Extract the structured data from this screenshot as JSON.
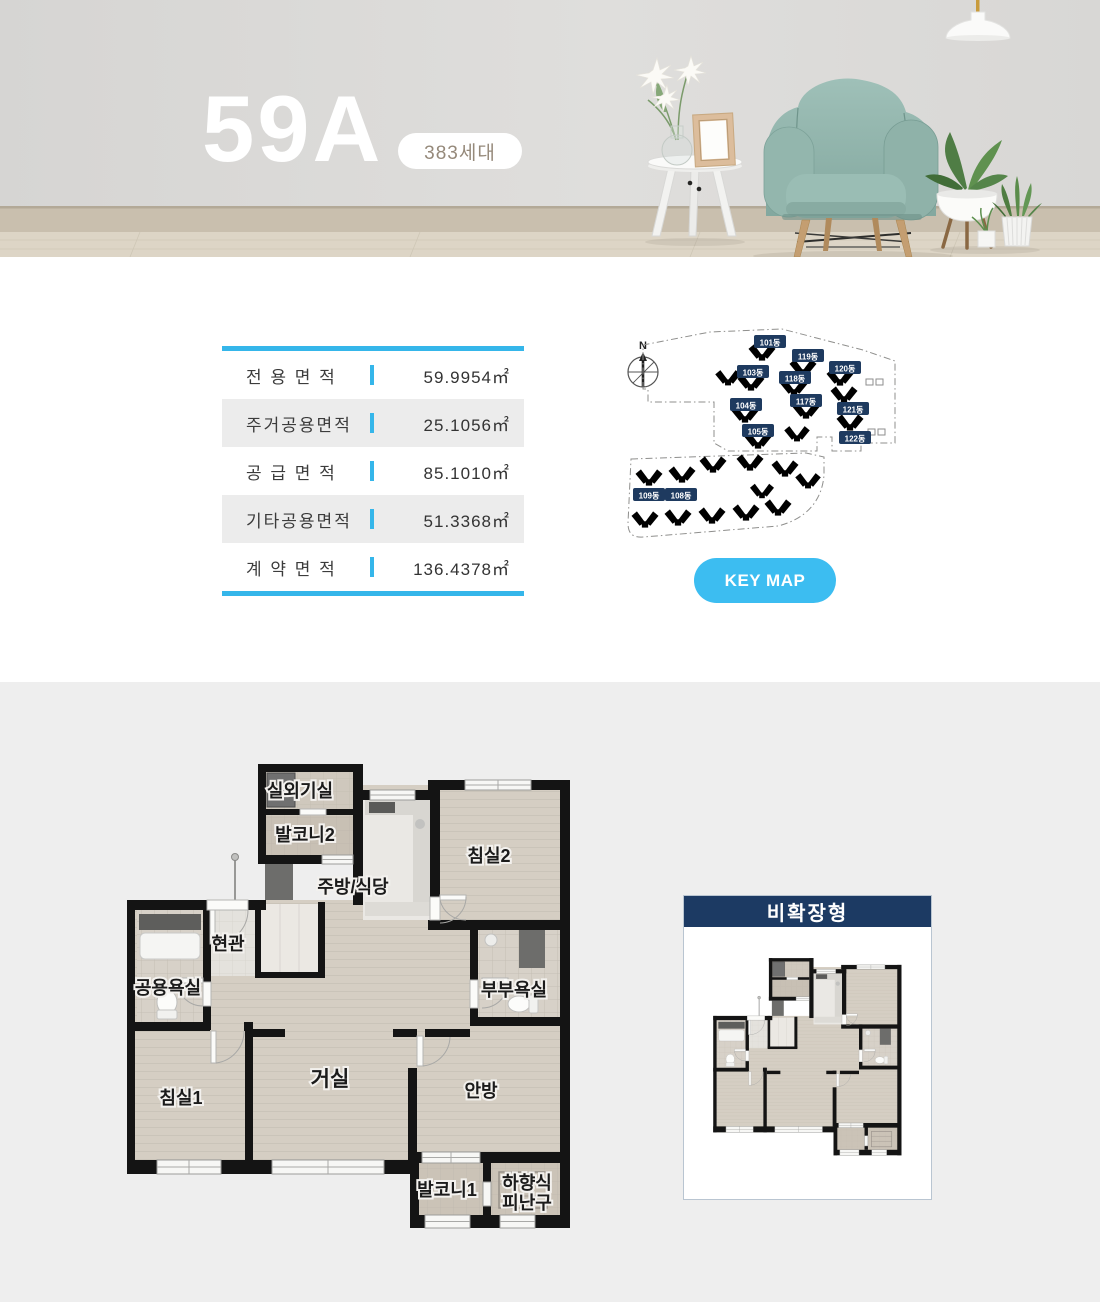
{
  "hero": {
    "title": "59A",
    "badge": "383세대"
  },
  "area_table": {
    "rows": [
      {
        "label": "전 용 면 적",
        "value": "59.9954㎡"
      },
      {
        "label": "주거공용면적",
        "value": "25.1056㎡"
      },
      {
        "label": "공 급 면 적",
        "value": "85.1010㎡"
      },
      {
        "label": "기타공용면적",
        "value": "51.3368㎡"
      },
      {
        "label": "계 약 면 적",
        "value": "136.4378㎡"
      }
    ]
  },
  "keymap": {
    "compass": "N",
    "button_label": "KEY MAP",
    "buildings": [
      "101동",
      "119동",
      "103동",
      "118동",
      "120동",
      "104동",
      "117동",
      "121동",
      "105동",
      "122동",
      "109동",
      "108동"
    ]
  },
  "floor_plan": {
    "rooms": [
      {
        "label": "실외기실"
      },
      {
        "label": "발코니2"
      },
      {
        "label": "주방/식당"
      },
      {
        "label": "침실2"
      },
      {
        "label": "현관"
      },
      {
        "label": "공용욕실"
      },
      {
        "label": "부부욕실"
      },
      {
        "label": "침실1"
      },
      {
        "label": "거실"
      },
      {
        "label": "안방"
      },
      {
        "label": "발코니1"
      },
      {
        "label": "하향식",
        "label2": "피난구"
      }
    ]
  },
  "panel": {
    "title": "비확장형"
  },
  "colors": {
    "accent_blue": "#35b6ea",
    "button_blue": "#3cbdf1",
    "navy": "#1c3a63",
    "badge_navy": "#1e3a5f",
    "highlight_building": "#46b4e4",
    "section_gray": "#eeeeee"
  }
}
